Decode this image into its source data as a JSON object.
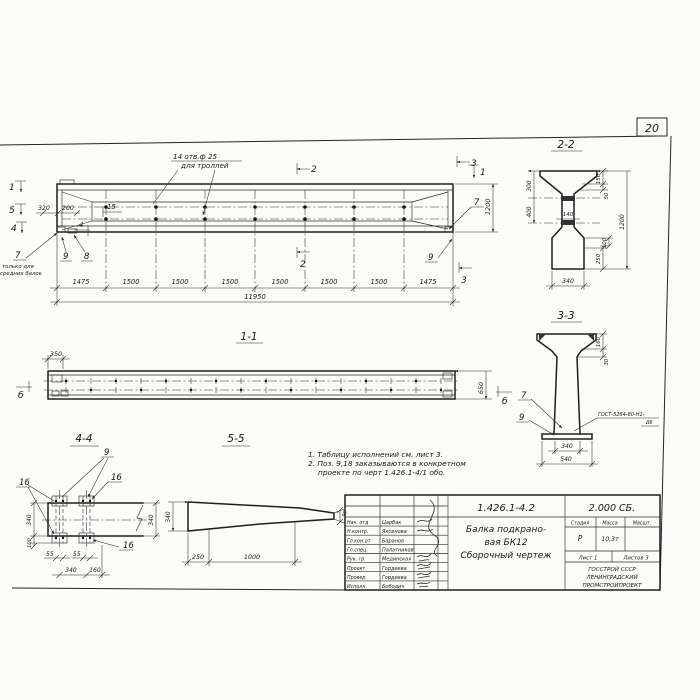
{
  "sheet": {
    "page_number": "20"
  },
  "main": {
    "hole_note1": "14 отв.ф 25",
    "hole_note2": "для троллей",
    "mark_1_left": "1",
    "mark_5_left": "5",
    "mark_4_left": "4",
    "dim_320": "320",
    "dim_200": "200",
    "label_15": "15",
    "mark_4_inner": "4",
    "pos_7_left": "7",
    "pos7_note1": "только для",
    "pos7_note2": "средних балок",
    "pos_9_left": "9",
    "pos_8": "8",
    "mark_2_top": "2",
    "mark_2_bottom": "2",
    "mark_3_top": "3",
    "mark_3_bottom": "3",
    "mark_1_right": "1",
    "pos_7_right": "7",
    "pos_9_right": "9",
    "dim_1200": "1200",
    "span_dims": [
      "1475",
      "1500",
      "1500",
      "1500",
      "1500",
      "1500",
      "1500",
      "1475"
    ],
    "dim_total": "11950"
  },
  "sec22": {
    "title": "2-2",
    "dim_300": "300",
    "dim_400": "400",
    "dim_150": "150",
    "dim_50": "50",
    "dim_1200": "1200",
    "dim_100": "100",
    "dim_250": "250",
    "dim_140": "140",
    "dim_340": "340"
  },
  "sec33": {
    "title": "3-3",
    "dim_160": "160",
    "dim_30": "30",
    "pos_7": "7",
    "pos_9": "9",
    "weld1": "ГОСТ-5264-80-Н1-",
    "weld2": "Δ6",
    "dim_340": "340",
    "dim_540": "540"
  },
  "sec11": {
    "title": "1-1",
    "dim_350": "350",
    "dim_650": "650",
    "mark_b_left": "б",
    "mark_b_right": "б"
  },
  "sec44": {
    "title": "4-4",
    "pos_9": "9",
    "pos_16_left": "16",
    "pos_16_right": "16",
    "pos_16_bottom": "16",
    "dim_340_left": "340",
    "dim_100": "100",
    "dim_55_a": "55",
    "dim_55_b": "55",
    "dim_340_bottom": "340",
    "dim_160": "160",
    "dim_340_right": "340"
  },
  "sec55": {
    "title": "5-5",
    "dim_340": "340",
    "dim_250": "250",
    "dim_1000": "1000",
    "dim_90": "90"
  },
  "notes": {
    "n1": "1. Таблицу исполнений см. лист 3.",
    "n2": "2. Поз. 9,18 заказываются в конкретном",
    "n3": "проекте по черт 1.426.1-4/1 обо."
  },
  "stamp": {
    "doc_number": "1.426.1-4.2",
    "doc_code": "2.000 СБ.",
    "title1": "Балка подкрано-",
    "title2": "вая БК12",
    "title3": "Сборочный чертеж",
    "h_stage": "Стадия",
    "h_mass": "Масса",
    "h_scale": "Масшт.",
    "v_stage": "Р",
    "v_mass": "10,3т",
    "sheet_label": "Лист 1",
    "sheets_label": "Листов 3",
    "org1": "ГОССТРОЙ СССР",
    "org2": "ЛЕНИНГРАДСКИЙ",
    "org3": "ПРОМСТРОЙПРОЕКТ",
    "rows": [
      {
        "role": "Нач. отд",
        "name": "Царбак"
      },
      {
        "role": "Н.контр.",
        "name": "Яксенова"
      },
      {
        "role": "Гл.кон.от",
        "name": "Баранов"
      },
      {
        "role": "Гл.спец.",
        "name": "Палатников"
      },
      {
        "role": "Рук. гр.",
        "name": "Мединская"
      },
      {
        "role": "Проект.",
        "name": "Гордеева"
      },
      {
        "role": "Провер.",
        "name": "Гордеева"
      },
      {
        "role": "Исполн.",
        "name": "Бободич"
      }
    ]
  }
}
